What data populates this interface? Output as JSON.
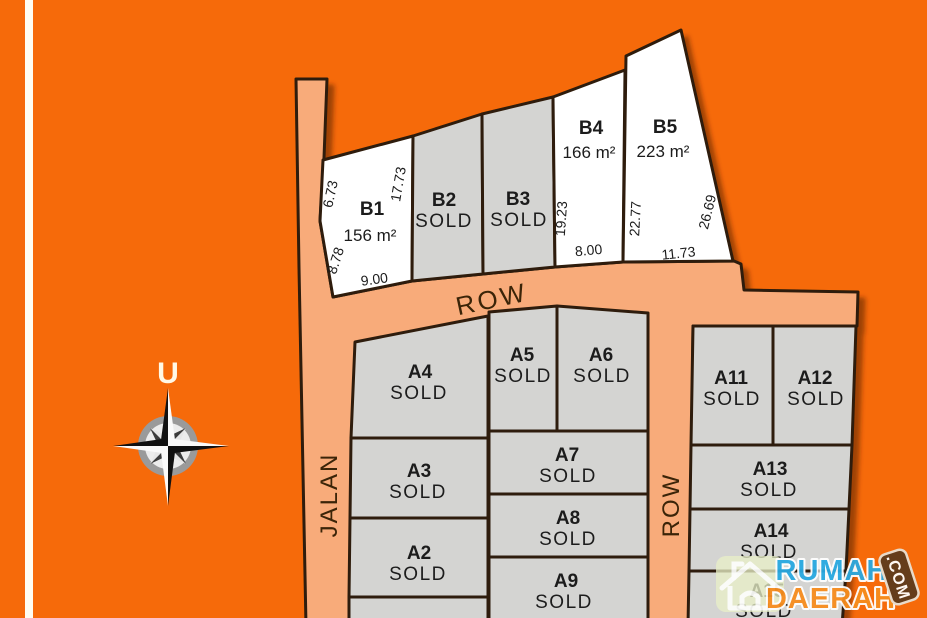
{
  "compass": {
    "north_label": "U"
  },
  "roads": {
    "jalan": "JALAN",
    "row_top": "ROW",
    "row_right": "ROW"
  },
  "plots": {
    "b1": {
      "id": "B1",
      "area": "156 m²"
    },
    "b2": {
      "id": "B2",
      "status": "SOLD"
    },
    "b3": {
      "id": "B3",
      "status": "SOLD"
    },
    "b4": {
      "id": "B4",
      "area": "166 m²"
    },
    "b5": {
      "id": "B5",
      "area": "223 m²"
    },
    "a2": {
      "id": "A2",
      "status": "SOLD"
    },
    "a3": {
      "id": "A3",
      "status": "SOLD"
    },
    "a4": {
      "id": "A4",
      "status": "SOLD"
    },
    "a5": {
      "id": "A5",
      "status": "SOLD"
    },
    "a6": {
      "id": "A6",
      "status": "SOLD"
    },
    "a7": {
      "id": "A7",
      "status": "SOLD"
    },
    "a8": {
      "id": "A8",
      "status": "SOLD"
    },
    "a9": {
      "id": "A9",
      "status": "SOLD"
    },
    "a11": {
      "id": "A11",
      "status": "SOLD"
    },
    "a12": {
      "id": "A12",
      "status": "SOLD"
    },
    "a13": {
      "id": "A13",
      "status": "SOLD"
    },
    "a14": {
      "id": "A14",
      "status": "SOLD"
    },
    "a15": {
      "id": "A15",
      "status": "SOLD"
    }
  },
  "dimensions": {
    "b1_upper_left": "6.73",
    "b1_right": "17.73",
    "b1_lower_left": "8.78",
    "b1_bottom": "9.00",
    "b4_left": "19.23",
    "b4_bottom": "8.00",
    "b5_left": "22.77",
    "b5_right": "26.69",
    "b5_bottom": "11.73"
  },
  "watermark": {
    "brand_line1": "RUMAH",
    "brand_line2": "DAERAH",
    "domain": ".COM"
  },
  "colors": {
    "background": "#F66A0A",
    "road": "#F8AB7A",
    "plot_sold": "#D4D4D2",
    "plot_available": "#FFFFFF",
    "outline": "#2F1C08",
    "brand_blue": "#29A9E1",
    "brand_orange": "#F78D1E",
    "domain_badge": "#5E3B1C"
  }
}
